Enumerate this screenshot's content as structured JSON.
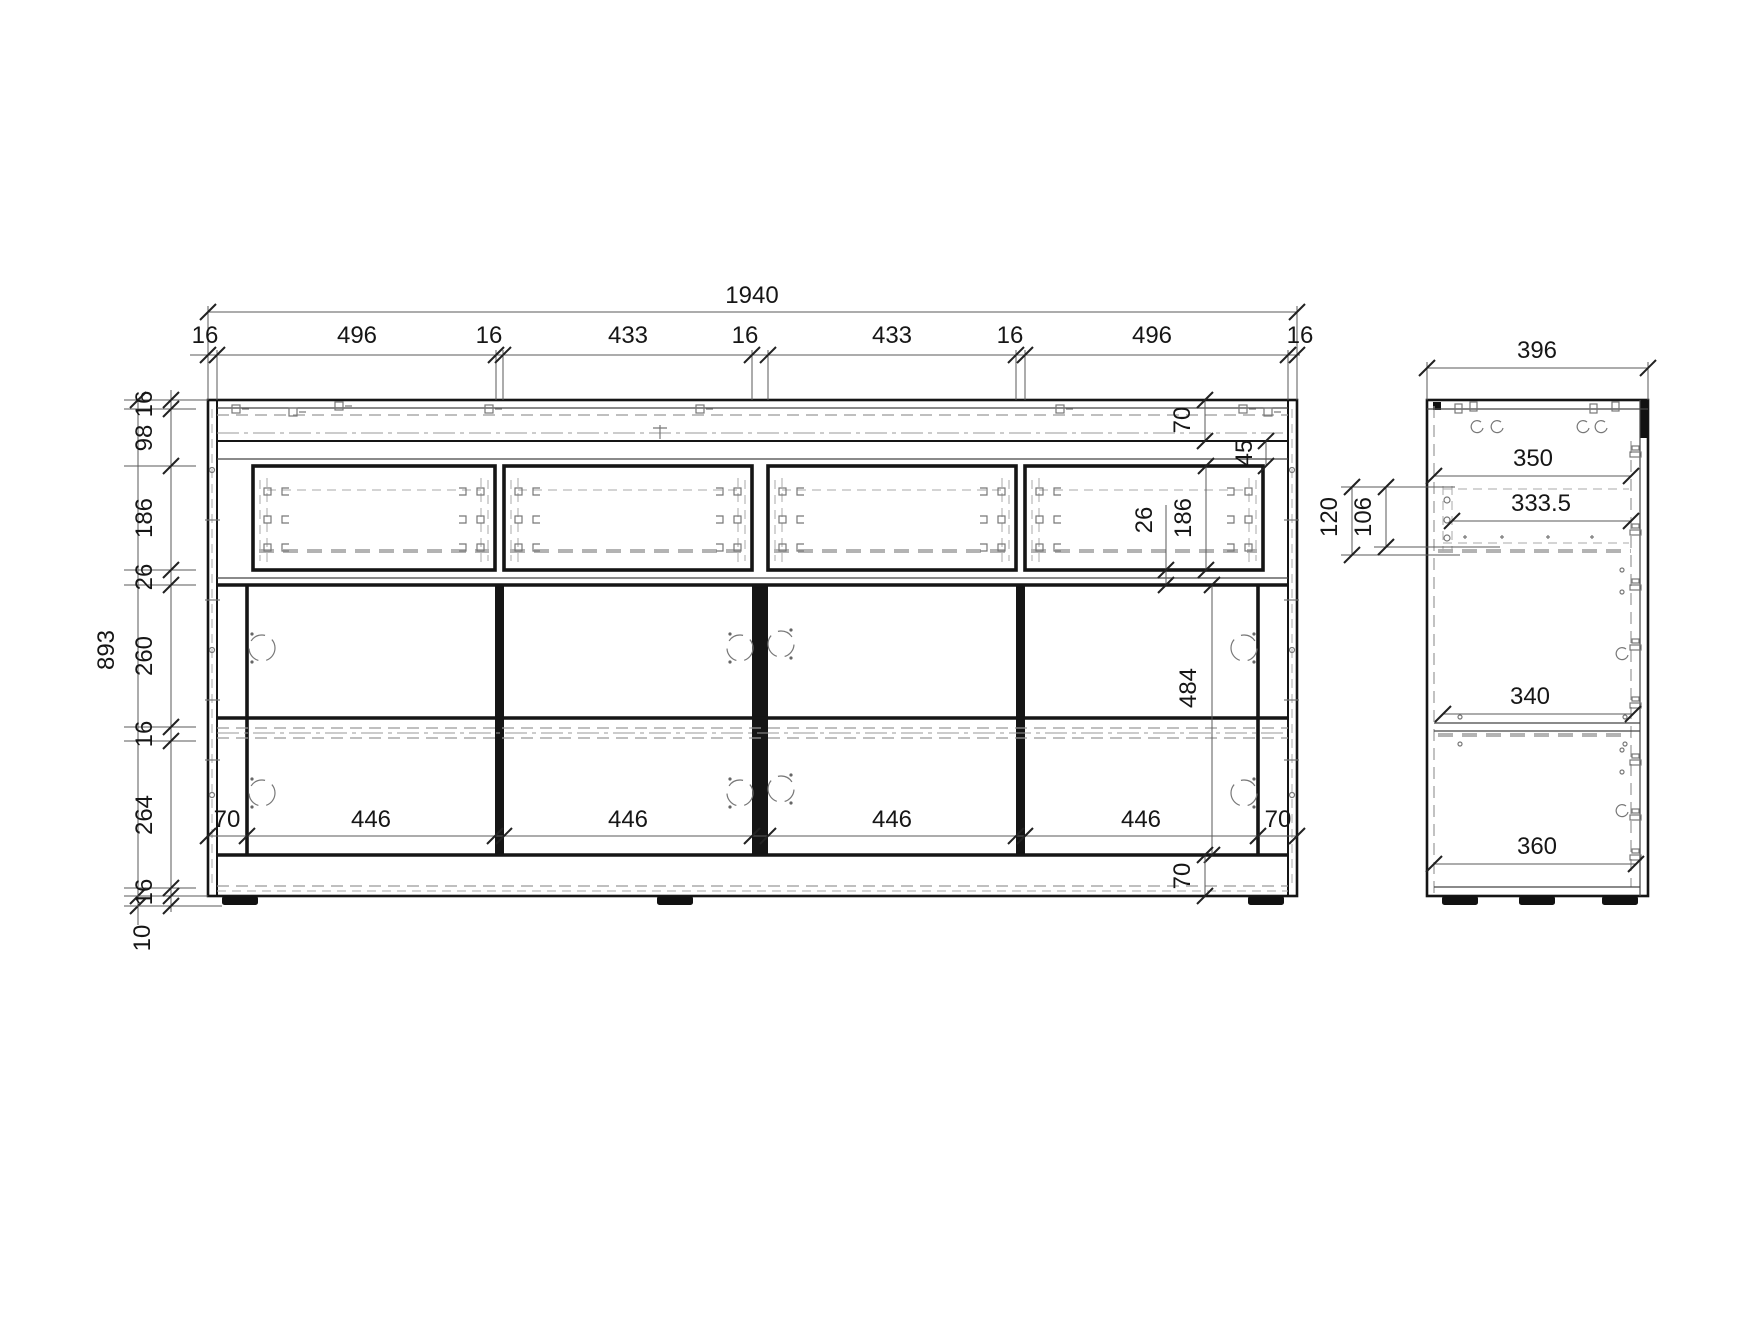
{
  "front_view": {
    "overall_width": "1940",
    "overall_height": "893",
    "top_chain": [
      "16",
      "496",
      "16",
      "433",
      "16",
      "433",
      "16",
      "496",
      "16"
    ],
    "left_chain": [
      "16",
      "98",
      "186",
      "26",
      "260",
      "16",
      "264",
      "16"
    ],
    "feet_height": "10",
    "top_rail_height": "70",
    "hinge_offset": "45",
    "drawer_gap": "26",
    "drawer_front_height": "186",
    "door_opening_height": "484",
    "door_widths": [
      "446",
      "446",
      "446",
      "446"
    ],
    "door_left_offset": "70",
    "door_right_offset": "70",
    "plinth_height": "70"
  },
  "side_view": {
    "overall_depth": "396",
    "top_interior_depth": "350",
    "drawer_depth": "333.5",
    "slide_offset_a": "120",
    "slide_offset_b": "106",
    "shelf_depth": "340",
    "bottom_interior_depth": "360"
  }
}
